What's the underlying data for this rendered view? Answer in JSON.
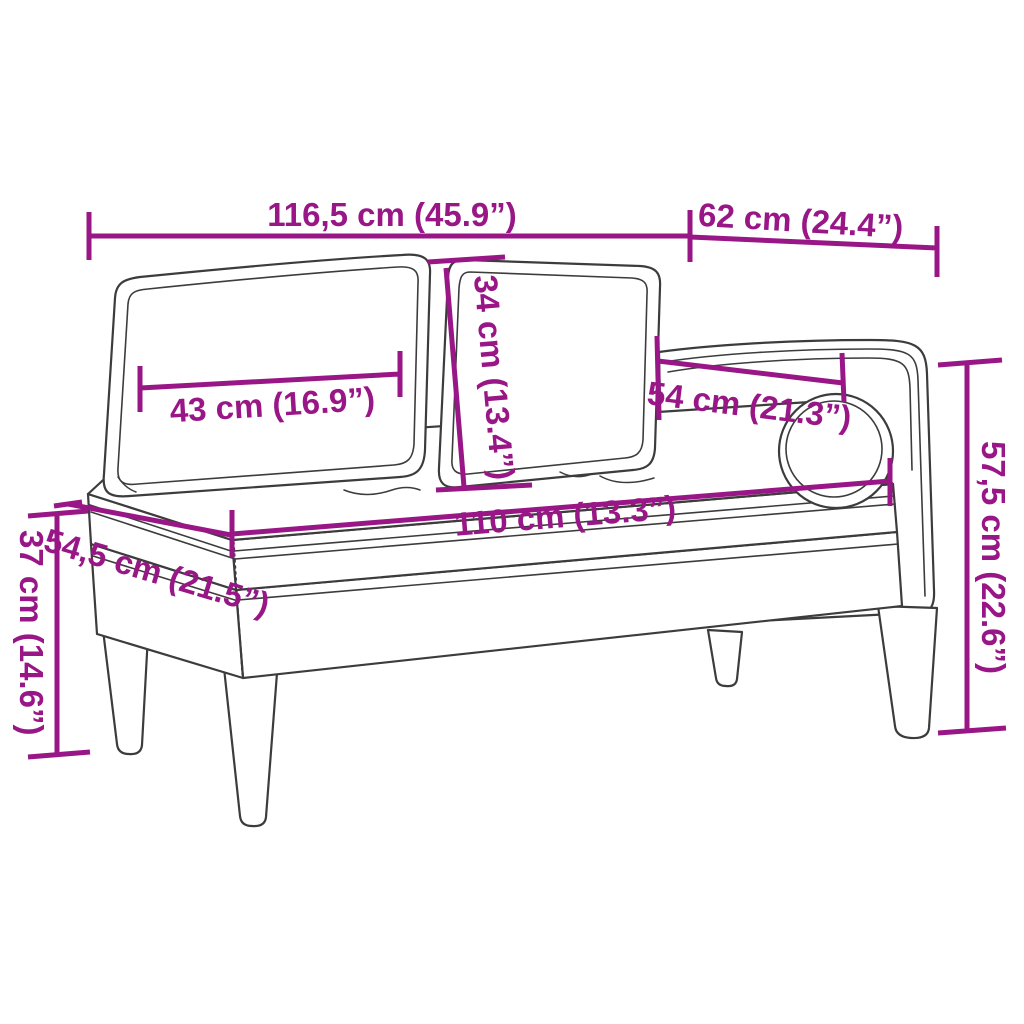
{
  "diagram": {
    "type": "product-dimension-drawing",
    "subject": "chaise-lounge-with-cushions-and-bolster"
  },
  "colors": {
    "dimension": "#991687",
    "outline": "#3c3c3c",
    "background": "#ffffff"
  },
  "dimensions": {
    "total_width": {
      "label": "116,5 cm (45.9”)"
    },
    "top_depth": {
      "label": "62 cm (24.4”)"
    },
    "cushion_width": {
      "label": "43 cm (16.9”)"
    },
    "cushion_height": {
      "label": "34 cm (13.4”)"
    },
    "armrest_width": {
      "label": "54 cm (21.3”)"
    },
    "seat_length": {
      "label": "110 cm (13.3”)"
    },
    "seat_depth": {
      "label": "54,5 cm (21.5”)"
    },
    "seat_height": {
      "label": "37 cm (14.6”)"
    },
    "total_height": {
      "label": "57,5 cm (22.6”)"
    }
  }
}
